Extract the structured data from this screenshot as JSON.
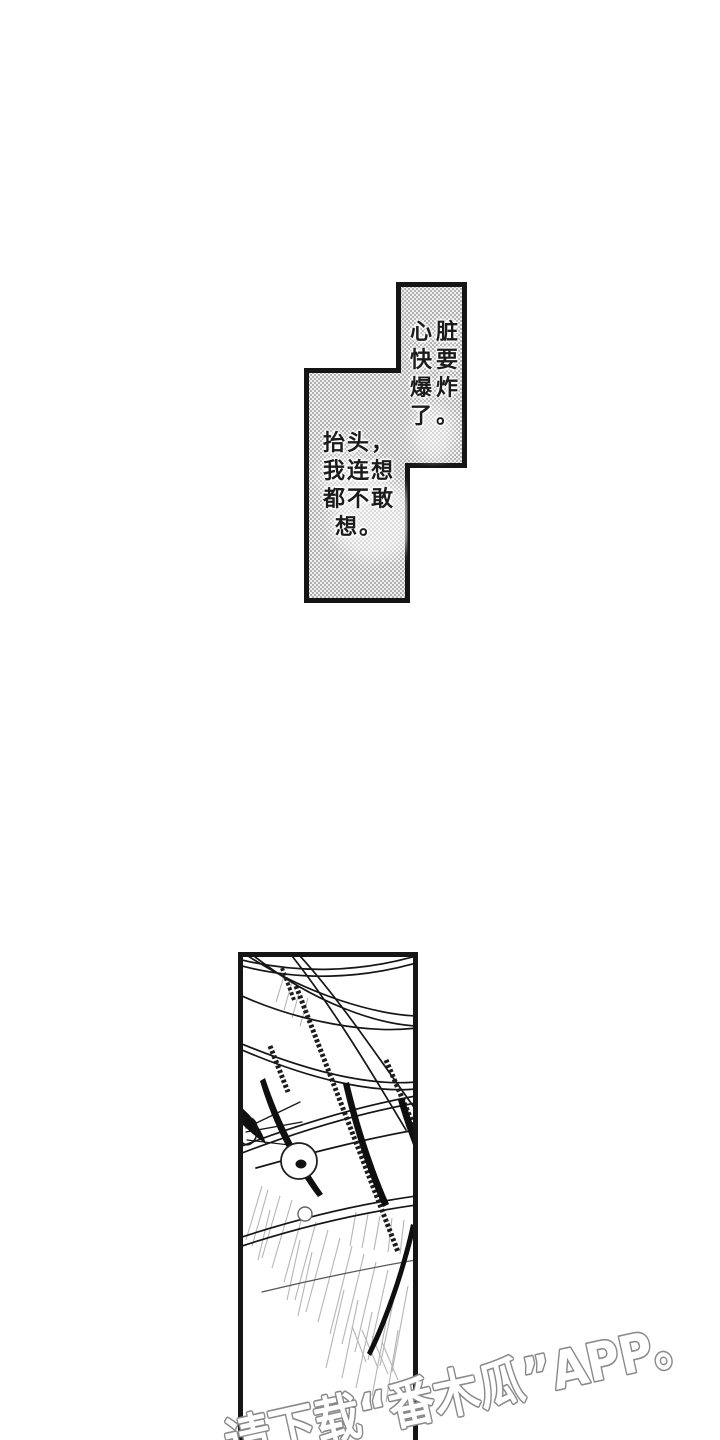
{
  "page": {
    "type": "manga-page",
    "background_color": "#ffffff",
    "ink_color": "#151515"
  },
  "bubbles": {
    "bubble_top": {
      "full_text": "心脏快要爆炸了。",
      "lines": [
        "心脏",
        "快要",
        "爆炸",
        "了。"
      ]
    },
    "bubble_bottom": {
      "full_text": "抬头，我连想都不敢想。",
      "lines": [
        "抬头，",
        "我连想",
        "都不敢",
        "想。"
      ]
    },
    "fill_style": "halftone-dots",
    "halftone_dot_color": "#9c9c9c",
    "halftone_bg_color": "#f1f1f1",
    "border_color": "#151515"
  },
  "panel": {
    "art_elements": [
      "hair-strand-curves",
      "eye-circle-with-pupil",
      "small-circle",
      "speed-line-hatching"
    ],
    "border_color": "#151515",
    "hatch_color": "#adadad"
  },
  "watermark": {
    "text": "请下载“番木瓜”APP。",
    "fill_color": "#ffffff",
    "outline_color": "#8a8a8a"
  }
}
